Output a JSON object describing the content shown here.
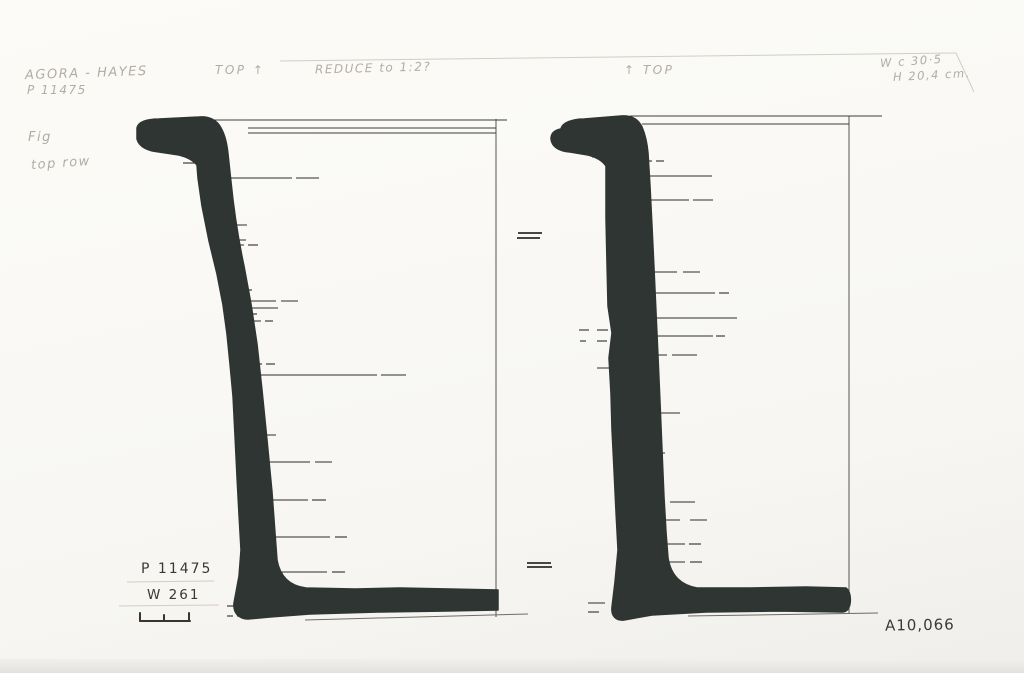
{
  "annotations": {
    "catalog_note": {
      "line1": "AGORA - HAYES",
      "line2": "P 11475"
    },
    "orientation_left": "TOP ↑",
    "reduction_note": "REDUCE to 1:2?",
    "orientation_right": "↑ TOP",
    "dimensions": {
      "width": "W c 30·5",
      "height": "H 20,4 cm."
    },
    "figure_note": "Fig",
    "row_note": "top row",
    "inventory_label": "P 11475",
    "ware_label": "W 261",
    "negative_number": "A10,066"
  },
  "colors": {
    "ink_profile": "#2e3533",
    "ruled_line": "#3f3d3a",
    "pencil": "#b2ada3",
    "ink_text": "#3b3934",
    "paper": "#faf9f5"
  },
  "drawing": {
    "description": "Two inked profile sections of a flat-based vessel with hooked rim, drawn to a vertical center axis",
    "left_profile": {
      "path": "M 137,128 C 138,122 147,119 159,119 L 199,117 C 209,116 217,120 221,128 C 225,135 227,144 228,154 L 231,182 C 234,212 238,238 244,266 L 251,304 L 257,344 L 262,390 L 267,440 L 272,492 L 275,533 L 277,560 C 280,577 290,586 306,588 L 355,589 L 400,588 L 450,589 L 498,590 L 498,610 L 448,611 L 378,612 L 310,614 L 270,617 L 248,619 C 239,619 233,613 234,603 L 239,576 L 241,550 L 239,515 L 237,477 L 235,436 L 233,396 L 230,364 L 227,334 L 223,305 L 217,274 L 209,241 L 202,206 L 198,178 L 197,165 C 193,160 187,157 179,155 L 159,152 C 148,151 139,147 137,139 Z",
      "axis": [
        496,
        119,
        496,
        617
      ],
      "rim_lines": [
        [
          212,
          120,
          507,
          120
        ],
        [
          248,
          128,
          496,
          128
        ],
        [
          248,
          133,
          496,
          133
        ]
      ],
      "base_line": [
        305,
        620,
        528,
        614
      ],
      "ticks": [
        {
          "y": 163,
          "segs": [
            [
              183,
              196
            ]
          ]
        },
        {
          "y": 178,
          "segs": [
            [
              213,
              292
            ],
            [
              296,
              319
            ]
          ]
        },
        {
          "y": 225,
          "segs": [
            [
              224,
              247
            ]
          ]
        },
        {
          "y": 240,
          "segs": [
            [
              227,
              246
            ]
          ]
        },
        {
          "y": 245,
          "segs": [
            [
              227,
              244
            ],
            [
              248,
              258
            ]
          ]
        },
        {
          "y": 290,
          "segs": [
            [
              238,
              252
            ]
          ]
        },
        {
          "y": 301,
          "segs": [
            [
              237,
              276
            ],
            [
              281,
              298
            ]
          ]
        },
        {
          "y": 308,
          "segs": [
            [
              241,
              278
            ]
          ]
        },
        {
          "y": 314,
          "segs": [
            [
              242,
              257
            ]
          ]
        },
        {
          "y": 321,
          "segs": [
            [
              242,
              261
            ],
            [
              265,
              273
            ]
          ]
        },
        {
          "y": 364,
          "segs": [
            [
              249,
              262
            ],
            [
              266,
              275
            ]
          ]
        },
        {
          "y": 375,
          "segs": [
            [
              250,
              377
            ],
            [
              381,
              406
            ]
          ]
        },
        {
          "y": 435,
          "segs": [
            [
              255,
              276
            ]
          ]
        },
        {
          "y": 462,
          "segs": [
            [
              257,
              310
            ],
            [
              315,
              332
            ]
          ]
        },
        {
          "y": 500,
          "segs": [
            [
              264,
              308
            ],
            [
              312,
              326
            ]
          ]
        },
        {
          "y": 537,
          "segs": [
            [
              268,
              330
            ],
            [
              335,
              347
            ]
          ]
        },
        {
          "y": 572,
          "segs": [
            [
              258,
              327
            ],
            [
              332,
              345
            ]
          ]
        },
        {
          "y": 606,
          "segs": [
            [
              227,
              239
            ]
          ]
        },
        {
          "y": 616,
          "segs": [
            [
              227,
              233
            ],
            [
              237,
              243
            ]
          ]
        }
      ]
    },
    "right_profile": {
      "path": "M 561,129 C 562,123 572,119 584,119 L 621,116 C 631,115 638,119 642,127 C 645,134 647,142 648,153 L 650,186 L 652,226 L 654,268 L 656,312 L 658,356 L 660,402 L 662,450 L 664,497 L 666,532 L 668,558 C 671,576 681,585 697,588 L 750,588 L 806,587 L 846,588 C 850,591 851,598 850,604 C 849,609 847,612 842,612 L 780,611 L 706,612 L 652,615 L 624,620 C 616,621 611,616 612,607 L 615,582 L 618,550 L 616,512 L 614,470 L 612,430 L 611,394 L 609,358 L 612,333 L 608,306 L 607,264 L 606,218 L 606,166 C 602,160 596,157 588,155 L 570,152 C 559,151 552,147 551,139 C 551,133 555,130 561,129 Z",
      "axis": [
        849,
        116,
        849,
        613
      ],
      "rim_lines": [
        [
          630,
          116,
          882,
          116
        ],
        [
          642,
          124,
          849,
          124
        ]
      ],
      "base_line": [
        688,
        616,
        878,
        613
      ],
      "ticks": [
        {
          "y": 157,
          "segs": [
            [
              592,
              613
            ]
          ]
        },
        {
          "y": 161,
          "segs": [
            [
              640,
              652
            ],
            [
              656,
              664
            ]
          ]
        },
        {
          "y": 176,
          "segs": [
            [
              634,
              712
            ]
          ]
        },
        {
          "y": 200,
          "segs": [
            [
              634,
              689
            ],
            [
              693,
              713
            ]
          ]
        },
        {
          "y": 272,
          "segs": [
            [
              633,
              677
            ],
            [
              683,
              700
            ]
          ]
        },
        {
          "y": 293,
          "segs": [
            [
              632,
              715
            ],
            [
              719,
              729
            ]
          ]
        },
        {
          "y": 318,
          "segs": [
            [
              630,
              737
            ]
          ]
        },
        {
          "y": 330,
          "segs": [
            [
              579,
              589
            ],
            [
              597,
              608
            ]
          ]
        },
        {
          "y": 336,
          "segs": [
            [
              630,
              713
            ],
            [
              716,
              725
            ]
          ]
        },
        {
          "y": 341,
          "segs": [
            [
              580,
              586
            ],
            [
              597,
              607
            ]
          ]
        },
        {
          "y": 355,
          "segs": [
            [
              632,
              667
            ],
            [
              672,
              697
            ]
          ]
        },
        {
          "y": 368,
          "segs": [
            [
              597,
              616
            ]
          ]
        },
        {
          "y": 413,
          "segs": [
            [
              632,
              655
            ],
            [
              659,
              680
            ]
          ]
        },
        {
          "y": 453,
          "segs": [
            [
              633,
              665
            ]
          ]
        },
        {
          "y": 492,
          "segs": [
            [
              635,
              648
            ]
          ]
        },
        {
          "y": 502,
          "segs": [
            [
              633,
              665
            ],
            [
              670,
              695
            ]
          ]
        },
        {
          "y": 520,
          "segs": [
            [
              636,
              680
            ],
            [
              690,
              707
            ]
          ]
        },
        {
          "y": 544,
          "segs": [
            [
              637,
              685
            ],
            [
              689,
              701
            ]
          ]
        },
        {
          "y": 562,
          "segs": [
            [
              635,
              685
            ],
            [
              690,
              702
            ]
          ]
        },
        {
          "y": 603,
          "segs": [
            [
              588,
              605
            ]
          ]
        },
        {
          "y": 612,
          "segs": [
            [
              588,
              599
            ]
          ]
        }
      ]
    },
    "equals_marks": [
      [
        518,
        233,
        542,
        233
      ],
      [
        517,
        238,
        540,
        238
      ],
      [
        527,
        563,
        551,
        563
      ],
      [
        527,
        567,
        552,
        567
      ]
    ],
    "scale_bar": {
      "baseline": [
        140,
        621,
        190,
        621
      ],
      "ticks": [
        [
          140,
          621,
          140,
          613
        ],
        [
          164,
          621,
          164,
          615
        ],
        [
          189,
          621,
          189,
          613
        ]
      ]
    },
    "pencil_guides": [
      [
        280,
        61,
        956,
        53
      ],
      [
        956,
        53,
        974,
        92
      ],
      [
        127,
        582,
        214,
        581
      ],
      [
        119,
        606,
        219,
        605
      ]
    ]
  }
}
